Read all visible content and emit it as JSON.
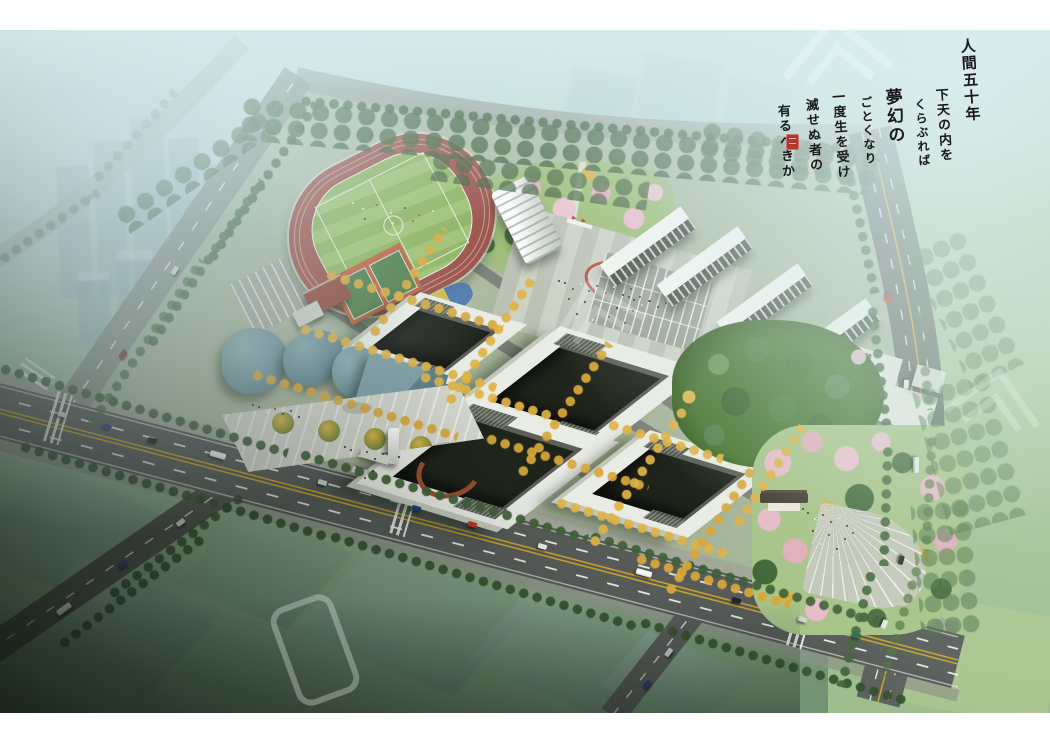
{
  "artwork": {
    "type": "aerial campus master-plan architectural rendering",
    "calligraphy": {
      "columns": [
        "人間五十年",
        "下天の内を",
        "くらぶれば",
        "夢幻の",
        "ごとくなり",
        "一度生を受け",
        "滅せぬ者の",
        "有るべきか"
      ],
      "seal_label": "red artist seal"
    },
    "palette": {
      "haze_sky": "#d7eaec",
      "lawn_green": "#a3c084",
      "track_red": "#9a4a40",
      "pitch_green": "#93b85f",
      "building_white": "#e9ece5",
      "courtyard_dark": "#20251c",
      "arts_center_teal": "#739aa2",
      "ginkgo_yellow": "#d8a83a",
      "cherry_pink": "#e9bcc9",
      "road_asphalt": "#565b58",
      "center_line_yellow": "#c9a12e",
      "seal_red": "#b0342a",
      "shadow_dark": "#141d15"
    },
    "scene_objects": [
      "city-haze-towers",
      "running-track",
      "football-pitch",
      "grandstand",
      "sports-courts",
      "red-gym-building",
      "north-parking",
      "central-garden",
      "campus-plaza",
      "plaza-emblem",
      "flag-monument",
      "courtyard-teaching-buildings",
      "dormitory-rows",
      "dormitory-parking",
      "arts-center-round-halls",
      "arts-center-box-hall",
      "forecourt-plaza",
      "entrance-gate-tower",
      "rust-sculpture-wall",
      "green-hill-park",
      "southeast-cherry-park",
      "fan-plaza",
      "traditional-gate-pavilion",
      "service-buildings",
      "main-road",
      "west-road",
      "north-road",
      "east-ring-road",
      "southwest-branch-road",
      "south-cross-road",
      "ginkgo-tree-rows",
      "roadside-trees",
      "pedestrians",
      "vehicles",
      "watermark-logo",
      "calligraphy-inscription",
      "artist-seal"
    ]
  }
}
